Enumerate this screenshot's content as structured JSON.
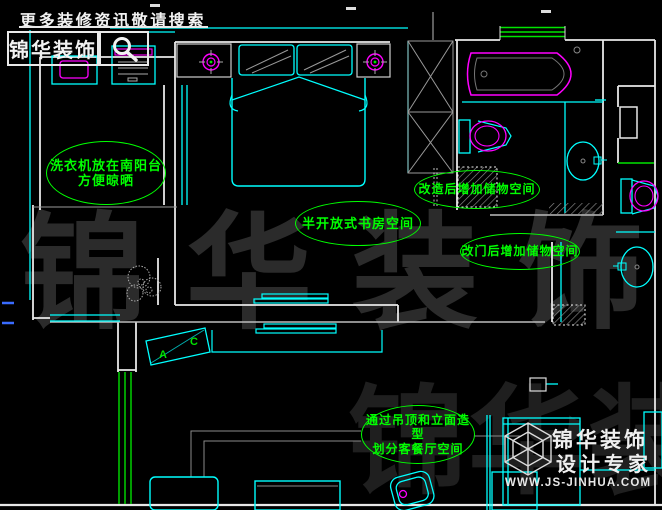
{
  "header": {
    "tagline": "更多装修资讯敬请搜索",
    "brand": "锦华装饰",
    "search_icon": "magnifier-icon"
  },
  "watermark": {
    "row1": "锦华装饰",
    "row2": "锦华装饰"
  },
  "annotations": [
    {
      "id": "balcony-washer",
      "lines": [
        "洗衣机放在南阳台",
        "方便晾晒"
      ]
    },
    {
      "id": "study",
      "lines": [
        "半开放式书房空间"
      ]
    },
    {
      "id": "storage-after-renovation",
      "lines": [
        "改造后增加储物空间"
      ]
    },
    {
      "id": "storage-after-door-change",
      "lines": [
        "改门后增加储物空间"
      ]
    },
    {
      "id": "living-dining",
      "lines": [
        "通过吊顶和立面造型",
        "划分客餐厅空间"
      ]
    }
  ],
  "ac_unit": {
    "letter_a": "A",
    "letter_c": "C"
  },
  "logo": {
    "brand_line1": "锦华装饰",
    "brand_line2": "设计专家",
    "website": "WWW.JS-JINHUA.COM"
  },
  "colors": {
    "background": "#000000",
    "wall": "#e8e8e8",
    "cad_cyan": "#00ffff",
    "cad_green": "#00e400",
    "cad_magenta": "#ff00ff",
    "annotation_green": "#00ff00",
    "watermark_gray": "#2b2b2b"
  }
}
